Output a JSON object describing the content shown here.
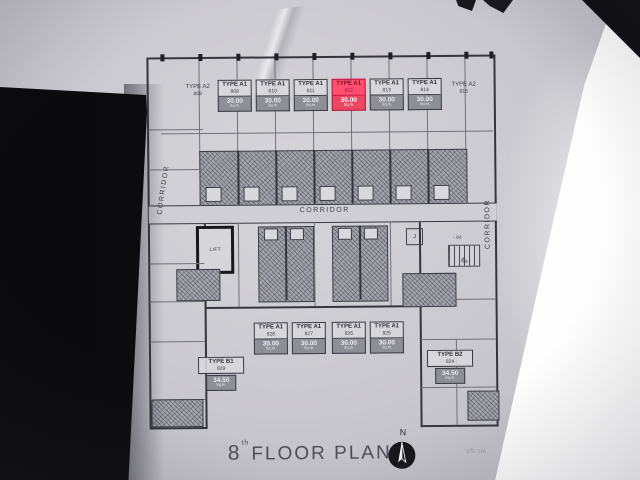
{
  "photo": {
    "paper_color": "#c9c8ce",
    "ink_color": "#35353d",
    "highlight_color": "#ff4f6e",
    "shade_color": "#a5a5ae"
  },
  "plan": {
    "corridor_label": "CORRIDOR",
    "corridor_left_label": "CORRIDOR",
    "corridor_right_label": "CORRIDOR",
    "lift_label": "LIFT",
    "stair_room_label": "J",
    "stair_down_label": "- ลง",
    "stair_up_label": "ขึ้น",
    "top_units": [
      {
        "type": "TYPE A2",
        "no": "808"
      },
      {
        "type": "TYPE A1",
        "no": "809",
        "area": "30.00",
        "sqm": "Sq.m."
      },
      {
        "type": "TYPE A1",
        "no": "810",
        "area": "30.00",
        "sqm": "Sq.m."
      },
      {
        "type": "TYPE A1",
        "no": "811",
        "area": "30.00",
        "sqm": "Sq.m."
      },
      {
        "type": "TYPE A1",
        "no": "812",
        "area": "30.00",
        "sqm": "Sq.m.",
        "highlighted": true
      },
      {
        "type": "TYPE A1",
        "no": "813",
        "area": "30.00",
        "sqm": "Sq.m."
      },
      {
        "type": "TYPE A1",
        "no": "814",
        "area": "30.00",
        "sqm": "Sq.m."
      },
      {
        "type": "TYPE A2",
        "no": "815"
      }
    ],
    "bottom_units": [
      {
        "type": "TYPE A1",
        "no": "828",
        "area": "30.00",
        "sqm": "Sq.m."
      },
      {
        "type": "TYPE A1",
        "no": "827",
        "area": "30.00",
        "sqm": "Sq.m."
      },
      {
        "type": "TYPE A1",
        "no": "826",
        "area": "30.00",
        "sqm": "Sq.m."
      },
      {
        "type": "TYPE A1",
        "no": "825",
        "area": "30.00",
        "sqm": "Sq.m."
      }
    ],
    "corner_units": [
      {
        "type": "TYPE B1",
        "no": "829",
        "area": "34.50",
        "sqm": "Sq.m."
      },
      {
        "type": "TYPE B2",
        "no": "824",
        "area": "34.50",
        "sqm": "Sq.m."
      }
    ]
  },
  "footer": {
    "floor_number": "8",
    "floor_suffix": "th",
    "title": "FLOOR PLAN",
    "north_label": "N",
    "side_note": "บริเวณ"
  }
}
